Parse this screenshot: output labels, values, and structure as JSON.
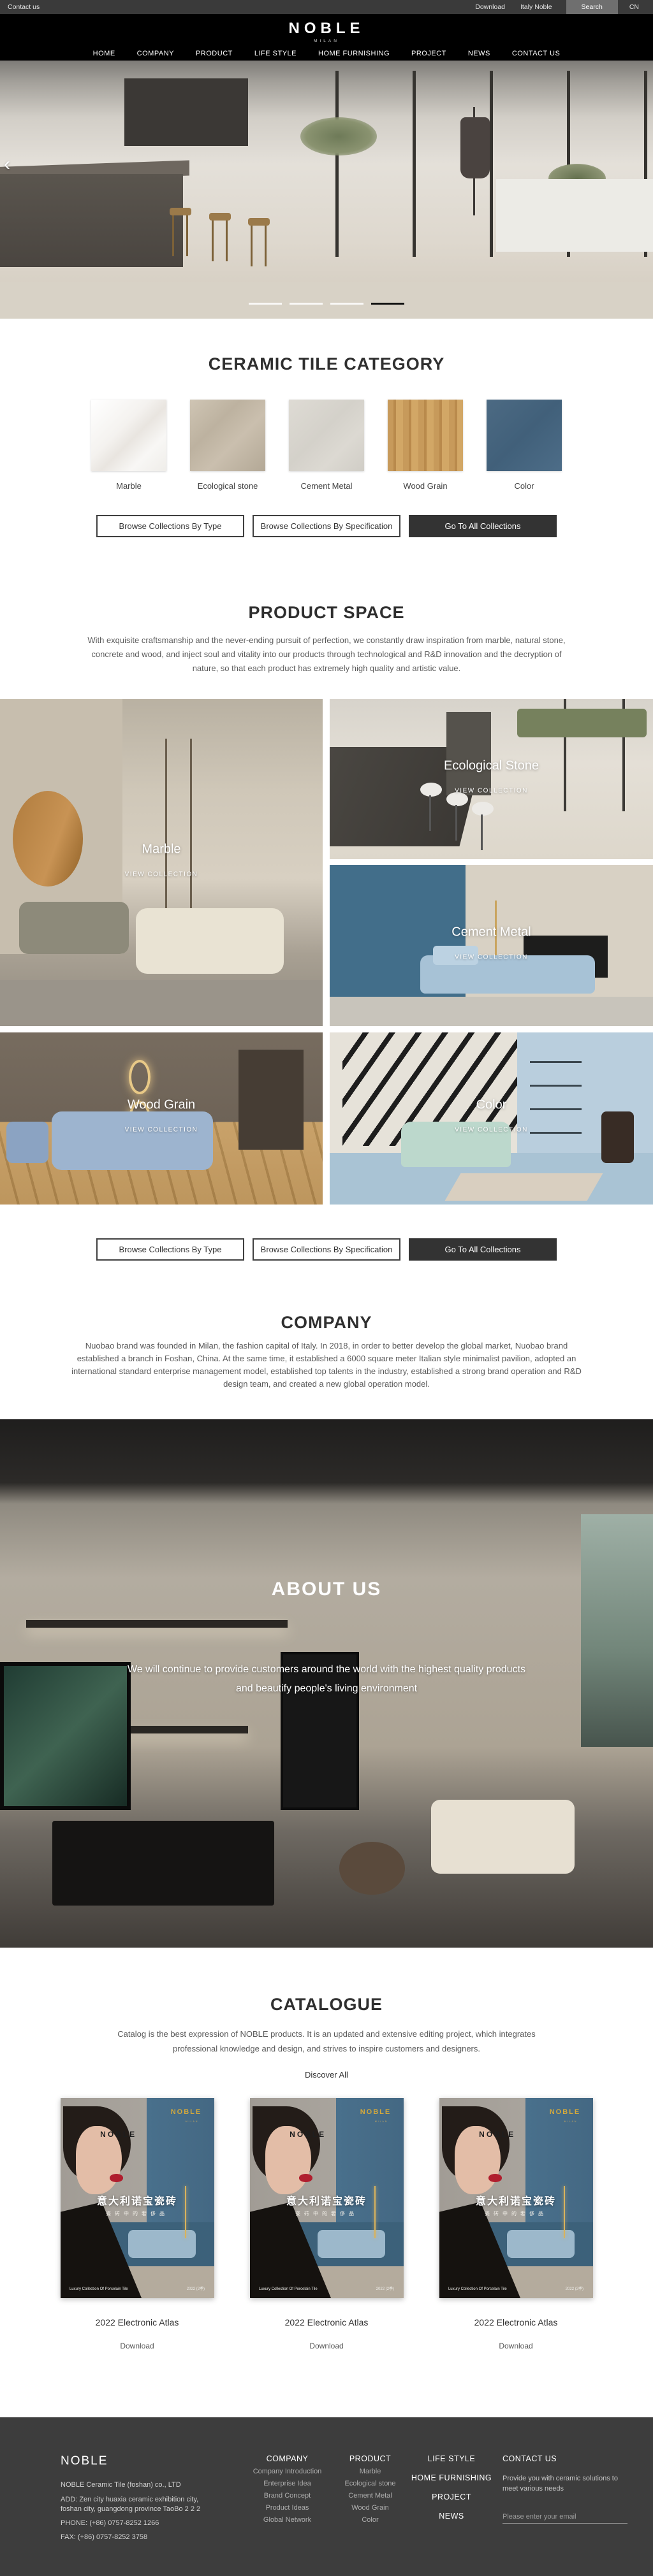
{
  "topbar": {
    "contact_us": "Contact us",
    "download": "Download",
    "italy_noble": "Italy Noble",
    "search": "Search",
    "lang": "CN"
  },
  "header": {
    "logo": "NOBLE",
    "logo_subtitle": "MILAN",
    "nav": [
      "HOME",
      "COMPANY",
      "PRODUCT",
      "LIFE STYLE",
      "HOME FURNISHING",
      "PROJECT",
      "NEWS",
      "CONTACT US"
    ]
  },
  "hero": {
    "prev_arrow": "‹",
    "slides_total": 4,
    "active_slide": 4
  },
  "category": {
    "title": "CERAMIC TILE CATEGORY",
    "tiles": [
      {
        "label": "Marble",
        "color": "#f2f0ec"
      },
      {
        "label": "Ecological stone",
        "color": "#c1b6a5"
      },
      {
        "label": "Cement Metal",
        "color": "#d7d4cd"
      },
      {
        "label": "Wood Grain",
        "color": "#c79a5b"
      },
      {
        "label": "Color",
        "color": "#46627c"
      }
    ]
  },
  "collection_buttons": {
    "by_type": "Browse Collections By Type",
    "by_spec": "Browse Collections By Specification",
    "all": "Go To All Collections"
  },
  "product_space": {
    "title": "PRODUCT SPACE",
    "description": "With exquisite craftsmanship and the never-ending pursuit of perfection, we constantly draw inspiration from marble, natural stone, concrete and wood, and inject soul and vitality into our products through technological and R&D innovation and the decryption of nature, so that each product has extremely high quality and artistic value.",
    "view_collection": "VIEW COLLECTION",
    "collections": [
      "Marble",
      "Ecological Stone",
      "Cement Metal",
      "Wood Grain",
      "Color"
    ]
  },
  "company": {
    "title": "COMPANY",
    "description": "Nuobao brand was founded in Milan, the fashion capital of Italy. In 2018, in order to better develop the global market, Nuobao brand established a branch in Foshan, China. At the same time, it established a 6000 square meter Italian style minimalist pavilion, adopted an international standard enterprise management model, established top talents in the industry, established a strong brand operation and R&D design team, and created a new global operation model."
  },
  "about": {
    "title": "ABOUT US",
    "description_line1": "We will continue to provide customers around the world with the highest quality products",
    "description_line2": "and beautify people's living environment"
  },
  "catalogue": {
    "title": "CATALOGUE",
    "description": "Catalog is the best expression of NOBLE products. It is an updated and extensive editing project, which integrates professional knowledge and design, and strives to inspire customers and designers.",
    "discover_all": "Discover All",
    "cover": {
      "brand_gold": "NOBLE",
      "brand_gold_sub": "MILAN",
      "brand_dark": "NOBLE",
      "title_cn": "意大利诺宝瓷砖",
      "subtitle_cn": "瓷砖中的奢侈品",
      "footer_left": "Luxury Collection Of Porcelain Tile",
      "footer_right": "2022 (2季)"
    },
    "items": [
      {
        "label": "2022 Electronic Atlas",
        "action": "Download"
      },
      {
        "label": "2022 Electronic Atlas",
        "action": "Download"
      },
      {
        "label": "2022 Electronic Atlas",
        "action": "Download"
      }
    ]
  },
  "footer": {
    "brand": "NOBLE",
    "company_line": "NOBLE Ceramic Tile (foshan) co., LTD",
    "address": "ADD:  Zen city huaxia ceramic exhibition city, foshan city, guangdong province TaoBo 2 2 2",
    "phone": "PHONE:   (+86)  0757-8252 1266",
    "fax": "FAX:   (+86)  0757-8252 3758",
    "columns": [
      {
        "title": "COMPANY",
        "items": [
          "Company Introduction",
          "Enterprise Idea",
          "Brand Concept",
          "Product Ideas",
          "Global Network"
        ]
      },
      {
        "title": "PRODUCT",
        "items": [
          "Marble",
          "Ecological stone",
          "Cement Metal",
          "Wood Grain",
          "Color"
        ]
      }
    ],
    "nav_column": [
      "LIFE STYLE",
      "HOME FURNISHING",
      "PROJECT",
      "NEWS"
    ],
    "contact": {
      "title": "CONTACT US",
      "text": "Provide you with ceramic solutions to meet various needs",
      "email_placeholder": "Please enter your email"
    }
  },
  "colors": {
    "topbar_bg": "#3a3a3a",
    "header_bg": "#000000",
    "footer_bg": "#3d3d3d",
    "button_dark": "#333333",
    "catalogue_gold": "#d4a93c"
  }
}
